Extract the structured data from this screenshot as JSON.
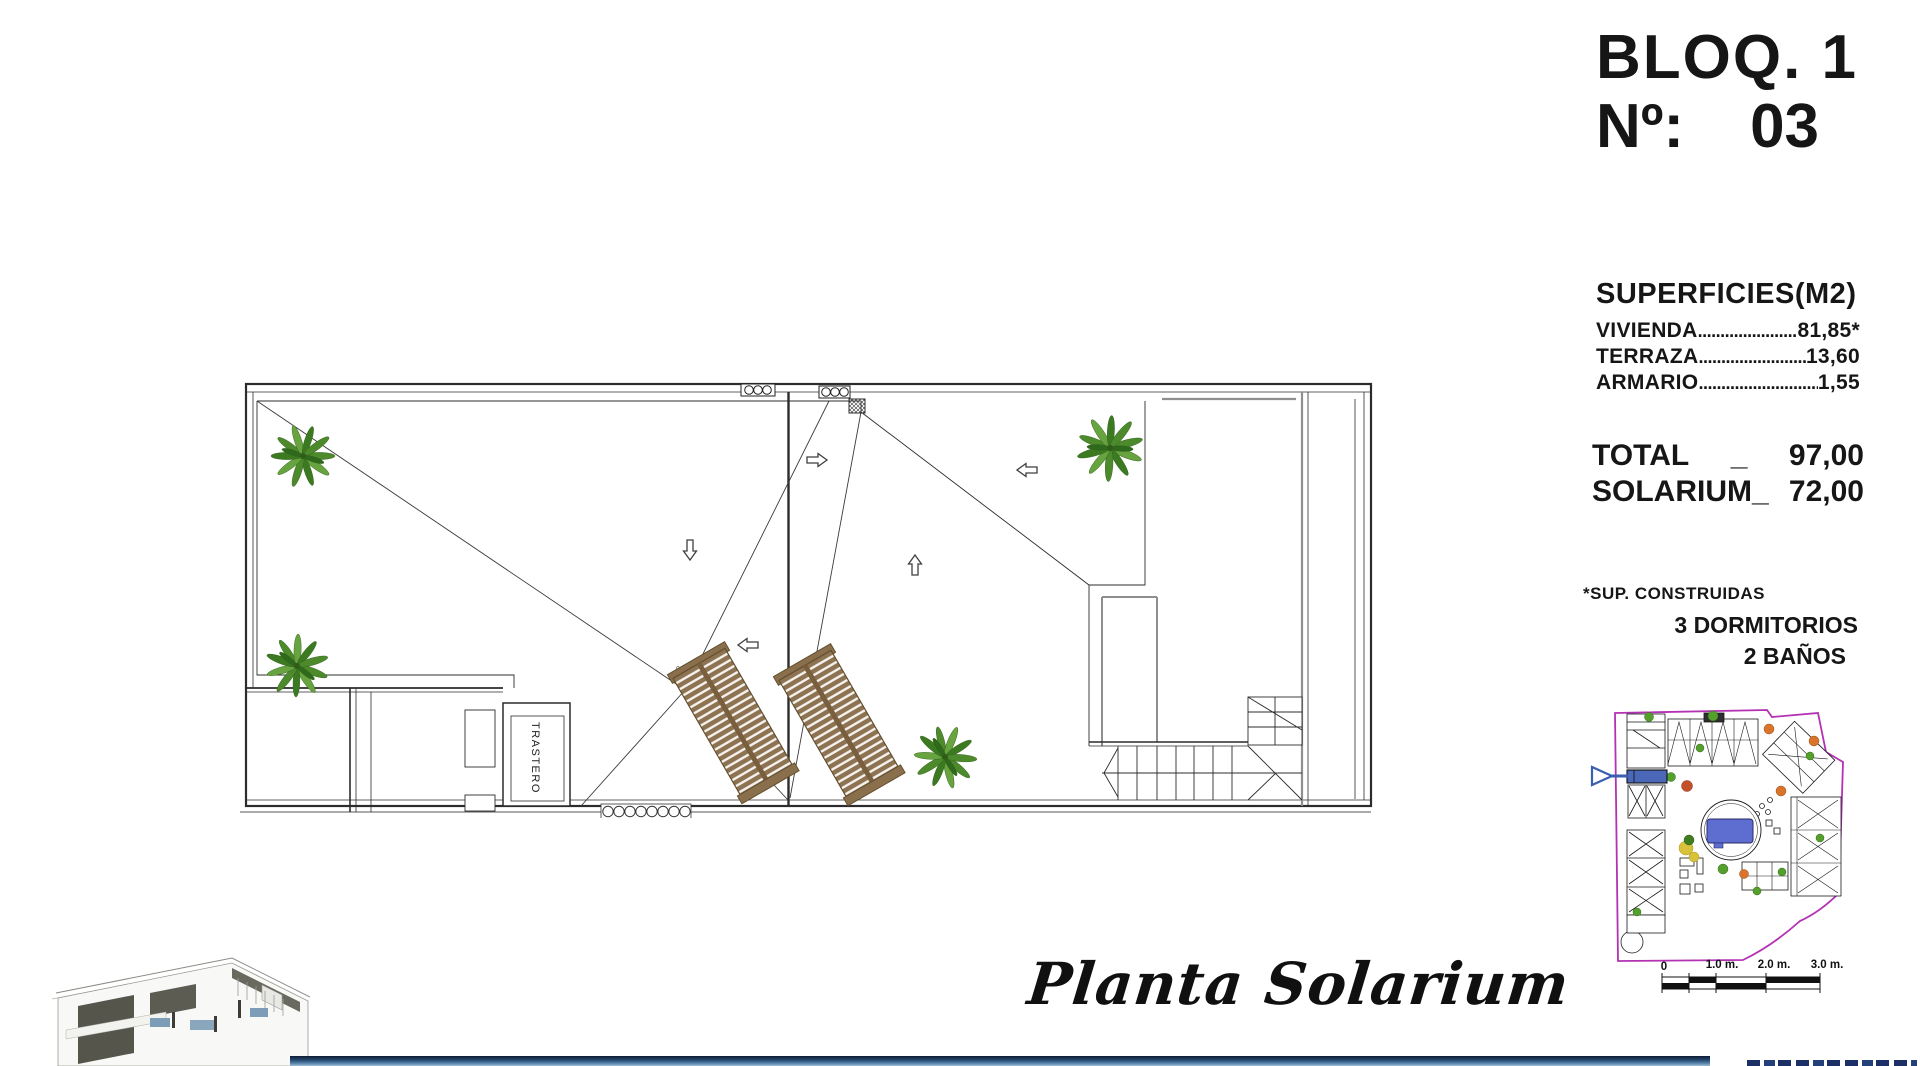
{
  "header": {
    "block": "BLOQ. 1",
    "unit_label": "Nº:",
    "unit_number": "03"
  },
  "surfaces": {
    "heading": "SUPERFICIES(M2)",
    "rows": [
      {
        "label": "VIVIENDA",
        "leader": "........................................",
        "value": "81,85*"
      },
      {
        "label": "TERRAZA",
        "leader": "........................................",
        "value": "13,60"
      },
      {
        "label": "ARMARIO",
        "leader": "........................................",
        "value": "1,55"
      }
    ],
    "total_label": "TOTAL",
    "total_sep": "_",
    "total_value": "97,00",
    "solarium_label": "SOLARIUM_",
    "solarium_value": "72,00",
    "footnote": "*SUP. CONSTRUIDAS"
  },
  "features": {
    "bedrooms": "3 DORMITORIOS",
    "bathrooms": "2 BAÑOS"
  },
  "plan": {
    "storage_label": "TRASTERO",
    "caption": "Planta Solarium"
  },
  "site_plan": {
    "scale_labels": [
      "0",
      "1.0 m.",
      "2.0 m.",
      "3.0 m."
    ]
  },
  "colors": {
    "accent_blue": "#4a67b8",
    "pointer_blue": "#3b5fb0",
    "boundary_magenta": "#b332b3",
    "palm_green": "#4c8a2c",
    "lounger_brown": "#8d7352",
    "bar_blue": "#24486f"
  }
}
